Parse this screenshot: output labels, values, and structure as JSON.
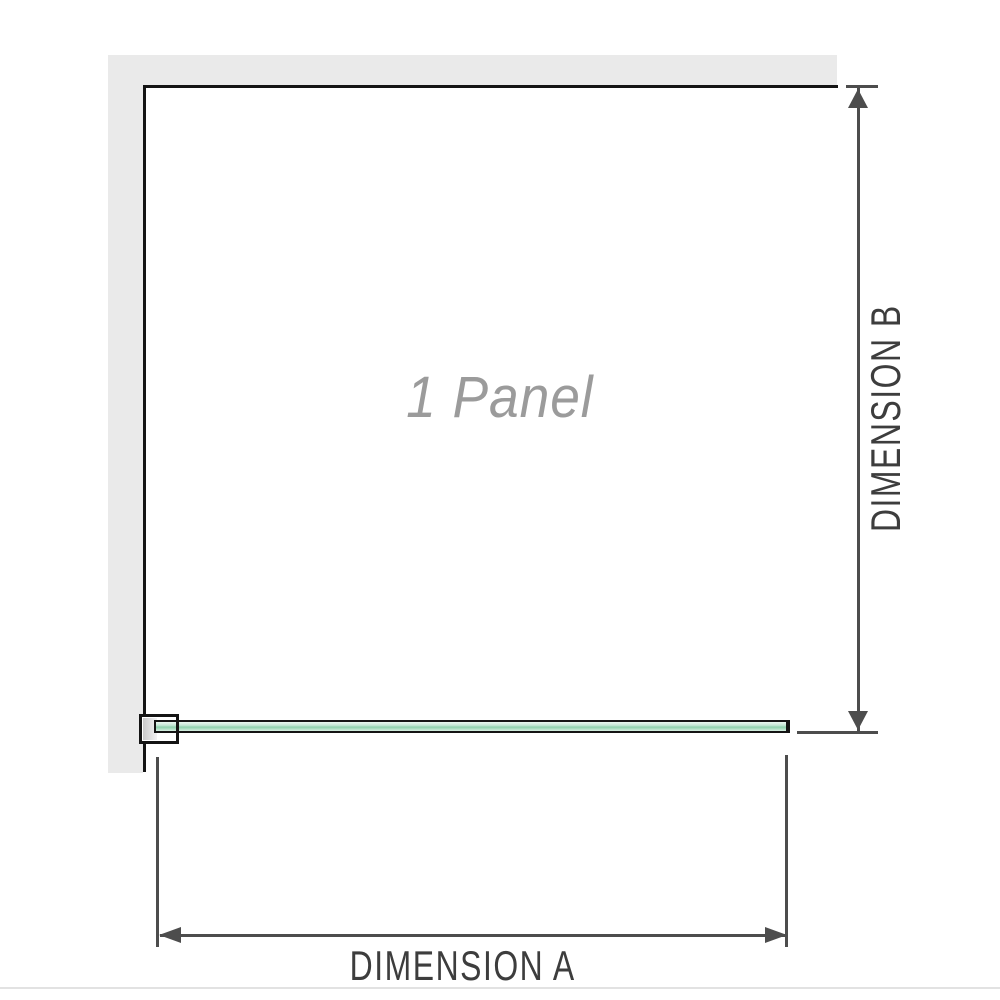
{
  "diagram": {
    "title": "1 Panel",
    "dimension_a": {
      "label": "DIMENSION A",
      "orientation": "horizontal"
    },
    "dimension_b": {
      "label": "DIMENSION B",
      "orientation": "vertical"
    },
    "panel_count": 1
  },
  "colors": {
    "wall_fill": "#eaeaea",
    "panel_outline": "#141414",
    "dimension_line": "#4d4d4d",
    "dimension_label_text": "#3d3d3d",
    "panel_label_text": "#9b9b9b",
    "glass_fill_light": "#cdeadb",
    "glass_fill_dark": "#8ccfab",
    "bottom_rule": "#e2e2e2"
  }
}
